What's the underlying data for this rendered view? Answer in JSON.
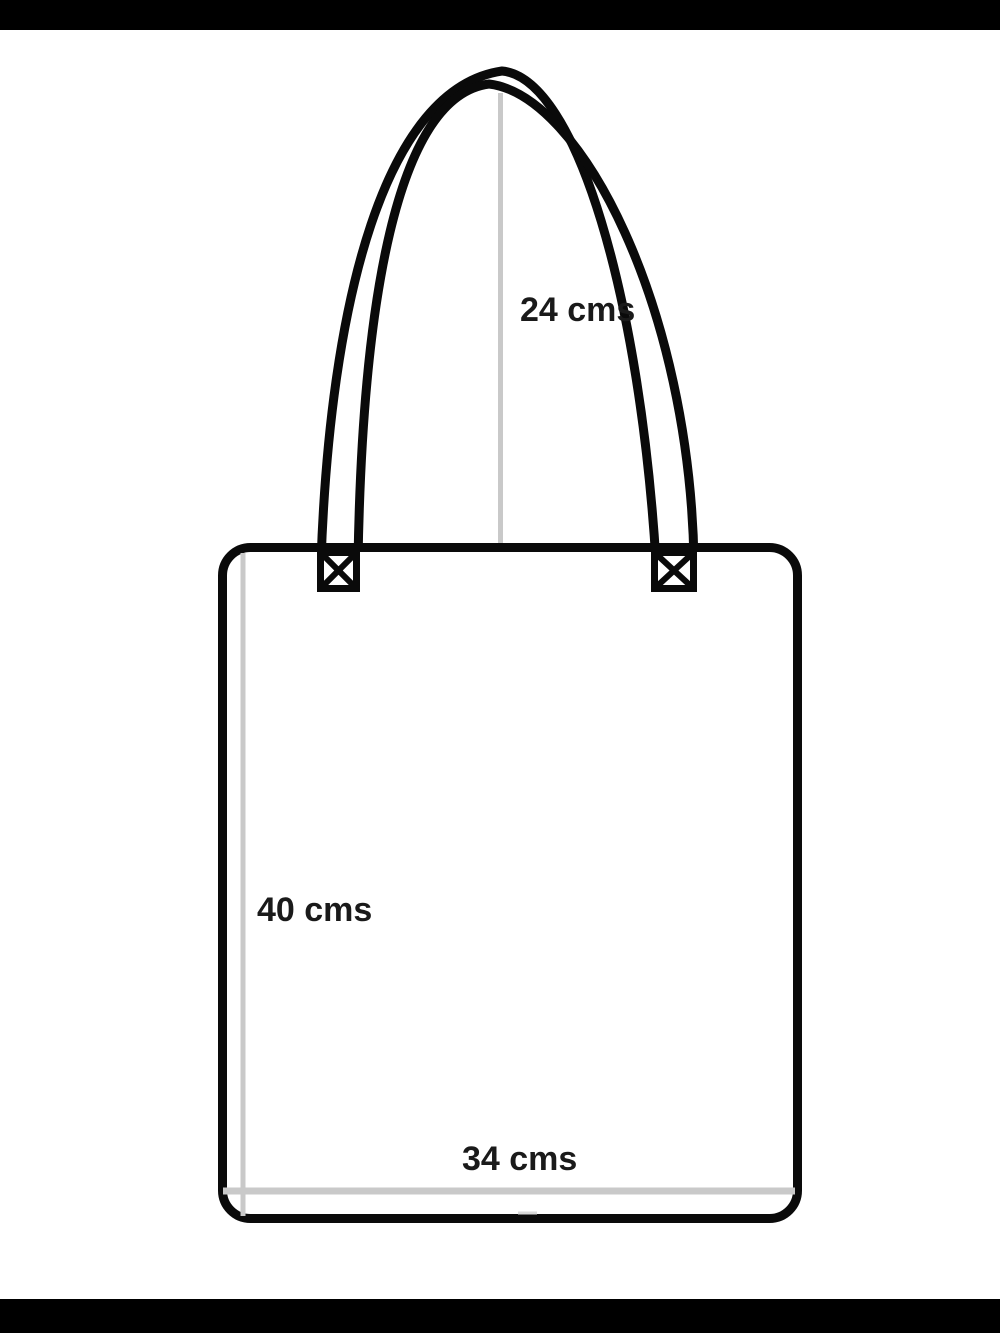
{
  "diagram": {
    "labels": {
      "handle": "24 cms",
      "height": "40 cms",
      "width": "34 cms"
    },
    "measurements_cm": {
      "handle_drop": 24,
      "bag_height": 40,
      "bag_width": 34
    },
    "colors": {
      "outline": "#0a0a0a",
      "measure_line": "#c9c9c9",
      "measure_line_light": "#d9d9d9",
      "label_text": "#1a1a1a",
      "canvas": "#ffffff",
      "letterbox": "#000000"
    }
  }
}
